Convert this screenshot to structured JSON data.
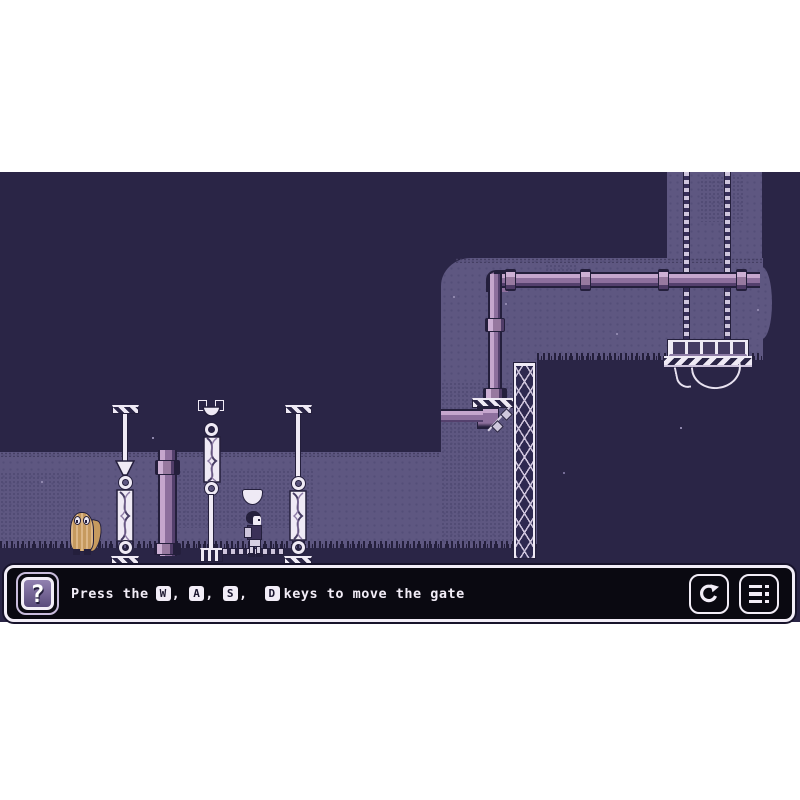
{
  "hud": {
    "question_glyph": "?",
    "hint": {
      "icon": "question-mark",
      "prefix": "Press the",
      "keys": [
        "W",
        "A",
        "S",
        "D"
      ],
      "comma": ",",
      "suffix": "keys to move the gate"
    },
    "buttons": [
      {
        "name": "restart",
        "icon": "restart-icon"
      },
      {
        "name": "menu",
        "icon": "menu-list-icon"
      }
    ]
  },
  "scene": {
    "entities": [
      "hanging-gate-platform",
      "chains",
      "pipes",
      "lattice-tower",
      "ornamental-pillars",
      "player-character",
      "shaggy-creature",
      "floating-bowl",
      "grass-ledges",
      "cave-terrain"
    ],
    "palette": {
      "background_navy": "#2a2546",
      "cave_wall": "#5e5781",
      "outline": "#241f3c",
      "pipe_highlight": "#c5a6cd",
      "pipe_mid": "#8d6f9d",
      "white": "#efeaf5",
      "creature_tan": "#c69a5f",
      "hud_black": "#0a0911",
      "hud_icon_purple": "#7a6a9a",
      "hud_icon_lavender": "#c9bcdc"
    }
  }
}
